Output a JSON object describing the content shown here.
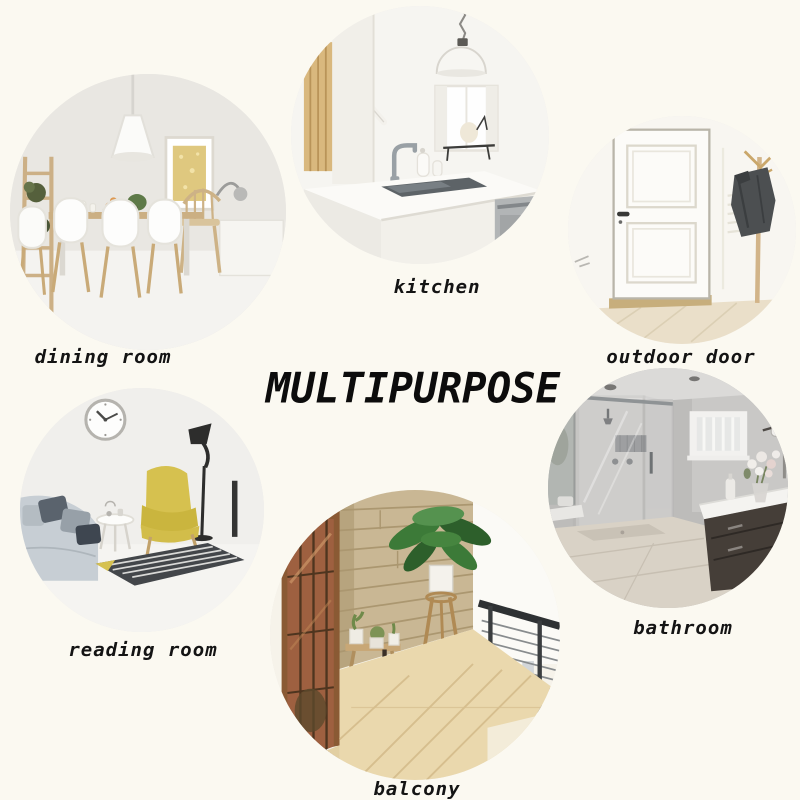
{
  "title": "MULTIPURPOSE",
  "rooms": [
    {
      "id": "dining-room",
      "label": "dining room"
    },
    {
      "id": "kitchen",
      "label": "kitchen"
    },
    {
      "id": "outdoor-door",
      "label": "outdoor door"
    },
    {
      "id": "reading-room",
      "label": "reading room"
    },
    {
      "id": "balcony",
      "label": "balcony"
    },
    {
      "id": "bathroom",
      "label": "bathroom"
    }
  ],
  "palette": {
    "background": "#fbf9f1",
    "label_text": "#141414",
    "title_text": "#0c0c0c",
    "accent_yellow_chair": "#d6c14f",
    "wood": "#c9ab7c",
    "plant_green": "#3c7a38",
    "coat_gray": "#4c4f51",
    "bathroom_wall_gray": "#bdbcba"
  }
}
